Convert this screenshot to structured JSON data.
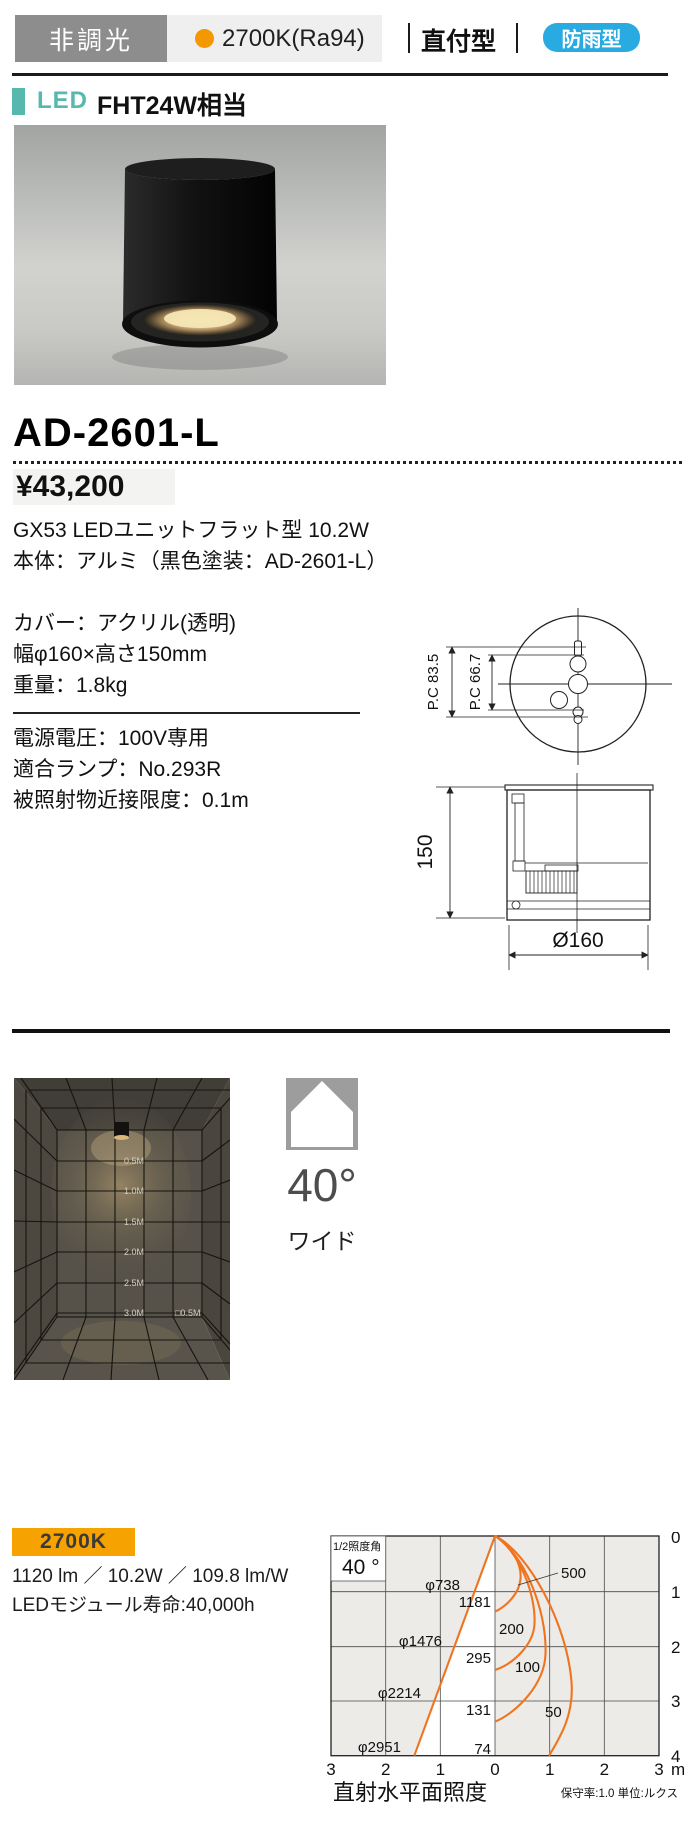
{
  "header": {
    "dimming_badge": "非調光",
    "color_temp_badge": "2700K(Ra94)",
    "mount_type": "直付型",
    "weather_badge": "防雨型",
    "colors": {
      "dimming_bg": "#8d8d8d",
      "temp_bg": "#efefef",
      "temp_dot": "#f39800",
      "weather_bg": "#29abe2"
    }
  },
  "lamp_header": {
    "led_label": "LED",
    "equivalent": "FHT24W相当",
    "accent_color": "#57b8ae"
  },
  "product": {
    "model": "AD-2601-L",
    "price": "¥43,200",
    "specs1": [
      "GX53 LEDユニットフラット型 10.2W",
      "本体：アルミ（黒色塗装：AD-2601-L）"
    ],
    "specs2": [
      "カバー：アクリル(透明)",
      "幅φ160×高さ150mm",
      "重量：1.8kg"
    ],
    "specs3": [
      "電源電圧：100V専用",
      "適合ランプ：No.293R",
      "被照射物近接限度：0.1m"
    ]
  },
  "drawing": {
    "pc_outer": "P.C 83.5",
    "pc_inner": "P.C 66.7",
    "height_mm": "150",
    "diameter": "Ø160"
  },
  "photometry_room": {
    "depth_labels": [
      "0.5M",
      "1.0M",
      "1.5M",
      "2.0M",
      "2.5M",
      "3.0M"
    ],
    "grid_label": "□0.5M"
  },
  "beam": {
    "angle": "40°",
    "spread": "ワイド"
  },
  "performance": {
    "color_temp": "2700K",
    "badge_bg": "#f6a200",
    "output_line": "1120 lm ／ 10.2W ／ 109.8 lm/W",
    "lifespan_line": "LEDモジュール寿命:40,000h"
  },
  "chart_data": {
    "type": "line",
    "title": "直射水平面照度",
    "note": "保守率:1.0 単位:ルクス",
    "half_angle_label": "1/2照度角",
    "half_angle_value": "40 °",
    "curve_color": "#f07420",
    "x_ticks": [
      "3",
      "2",
      "1",
      "0",
      "1",
      "2",
      "3"
    ],
    "x_unit": "m",
    "y_ticks": [
      "0",
      "1",
      "2",
      "3",
      "4"
    ],
    "x_axis_range_m": [
      -3,
      3
    ],
    "y_axis_range_m": [
      0,
      4
    ],
    "distance_m": [
      1,
      2,
      3,
      4
    ],
    "beam_diameter_labels": [
      "φ738",
      "φ1476",
      "φ2214",
      "φ2951"
    ],
    "beam_diameter_mm": [
      738,
      1476,
      2214,
      2951
    ],
    "center_illuminance_lx": [
      1181,
      295,
      131,
      74
    ],
    "iso_lux_labels": [
      "500",
      "200",
      "100",
      "50"
    ],
    "iso_lux_values": [
      500,
      200,
      100,
      50
    ]
  }
}
